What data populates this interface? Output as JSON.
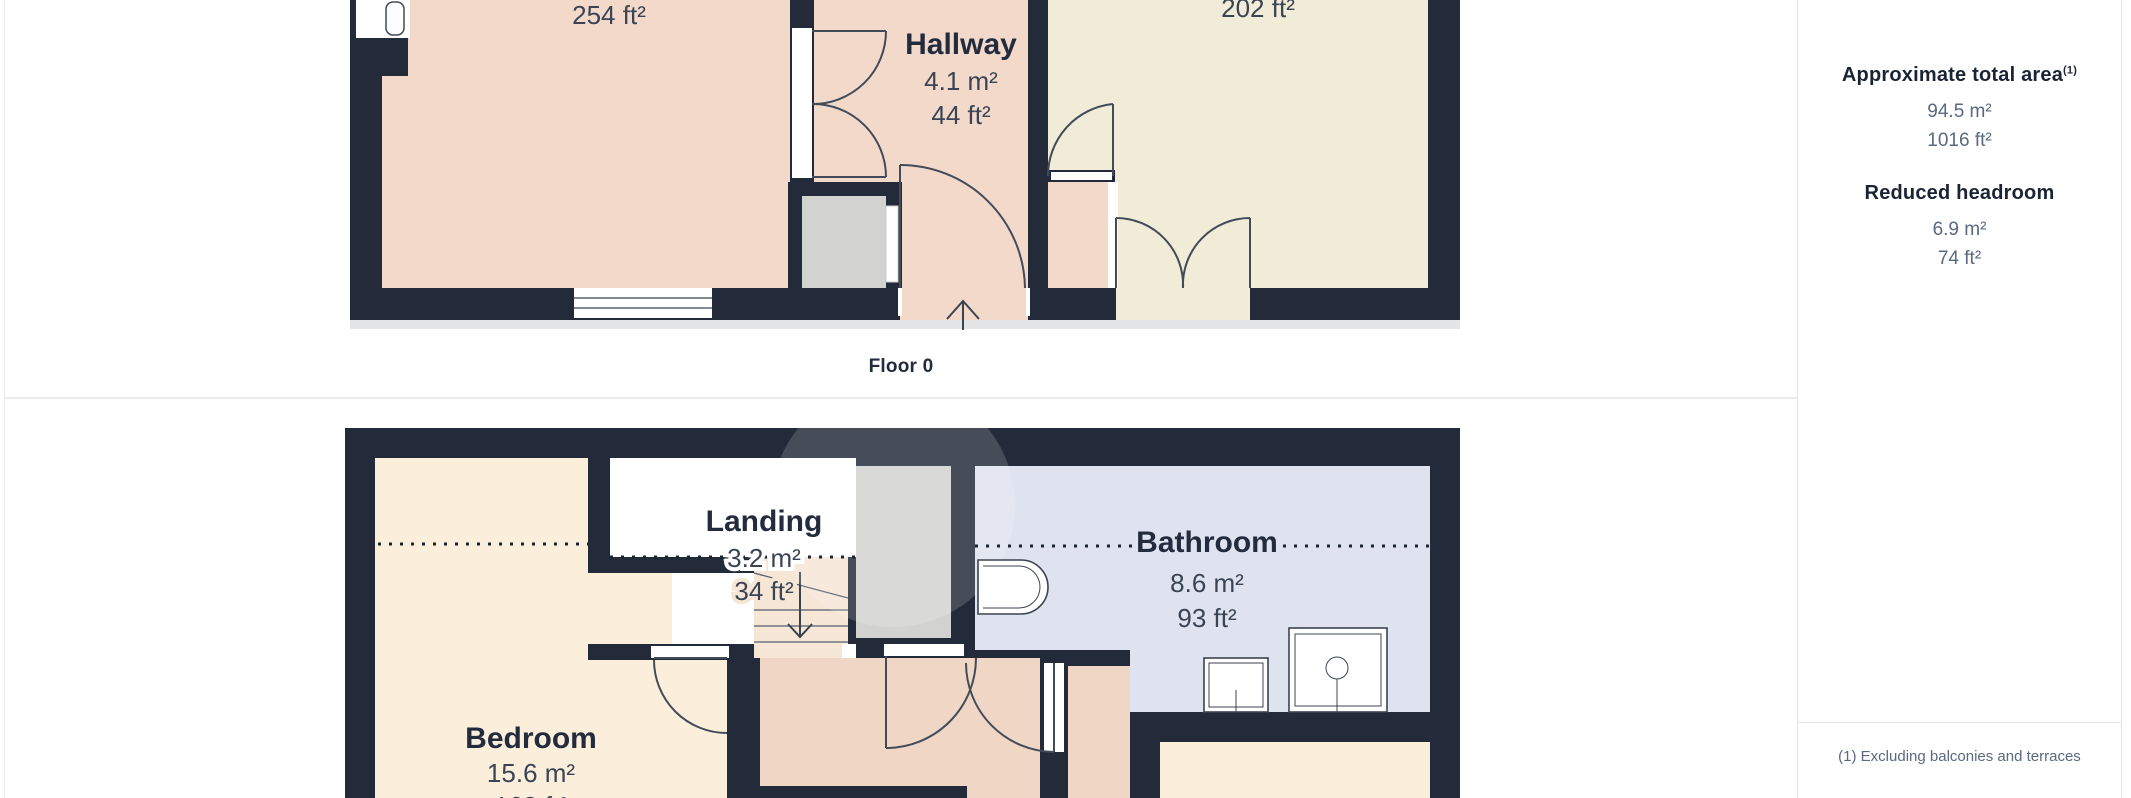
{
  "floor0": {
    "caption": "Floor 0",
    "living_area_ft2": "254 ft²",
    "kitchen_area_ft2": "202 ft²",
    "hallway": {
      "name": "Hallway",
      "m2": "4.1 m²",
      "ft2": "44 ft²"
    }
  },
  "floor1": {
    "landing": {
      "name": "Landing",
      "m2": "3.2 m²",
      "ft2": "34 ft²"
    },
    "bathroom": {
      "name": "Bathroom",
      "m2": "8.6 m²",
      "ft2": "93 ft²"
    },
    "bedroom": {
      "name": "Bedroom",
      "m2": "15.6 m²",
      "ft2": "168 ft²"
    }
  },
  "sidebar": {
    "total_heading": "Approximate total area",
    "footnote_marker": "(1)",
    "total_m2": "94.5 m²",
    "total_ft2": "1016 ft²",
    "reduced_heading": "Reduced headroom",
    "reduced_m2": "6.9 m²",
    "reduced_ft2": "74 ft²",
    "footnote": "(1) Excluding balconies and terraces"
  },
  "colors": {
    "wall": "#232B3A",
    "room_pink": "#F2D9CA",
    "room_pink_dark": "#EFD6C5",
    "room_cream": "#F1ECD7",
    "room_peach": "#FBEEDB",
    "room_blue": "#DFE3EF",
    "shaft_gray": "#D2D2D0",
    "stairs": "#F6E6D6",
    "label_dark": "#232C3E",
    "label_gray": "#5A6880",
    "divider": "#E9E9E9"
  }
}
